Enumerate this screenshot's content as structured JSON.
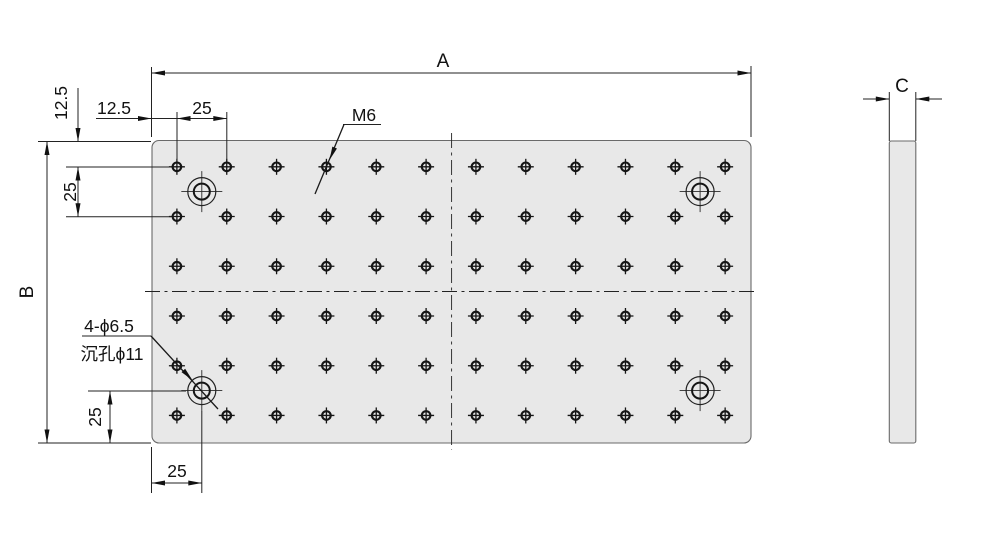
{
  "drawing": {
    "type": "engineering-drawing",
    "views": {
      "front": {
        "labels": {
          "width_dim": "A",
          "height_dim": "B",
          "edge_offset_horizontal": "12.5",
          "edge_offset_vertical": "12.5",
          "hole_pitch_horizontal": "25",
          "hole_pitch_vertical": "25",
          "cbore_offset_vertical": "25",
          "cbore_offset_horizontal": "25",
          "thread_callout": "M6",
          "cbore_callout_line1": "4-ϕ6.5",
          "cbore_callout_line2": "沉孔ϕ11"
        },
        "hole_grid": {
          "rows": 6,
          "cols": 12,
          "thread": "M6",
          "pitch": "25",
          "edge_offset": "12.5"
        },
        "counterbores": {
          "count": 4,
          "drill_diameter": "ϕ6.5",
          "cbore_diameter": "ϕ11",
          "offset_from_edges": "25"
        }
      },
      "side": {
        "labels": {
          "thickness_dim": "C"
        }
      }
    },
    "colors": {
      "plate_fill": "#e8e8e8",
      "line": "#222222",
      "text": "#111111",
      "background": "#ffffff"
    }
  },
  "geometry": {
    "plate": {
      "x": 152,
      "y": 140.5,
      "w": 599,
      "h": 302.5,
      "rx": 7
    },
    "grid": {
      "x0": 176.9,
      "y0": 166.8,
      "dx": 49.84,
      "dy": 49.73,
      "cols": 12,
      "rows": 6
    },
    "cbores": [
      [
        201.8,
        191.6
      ],
      [
        700.1,
        191.6
      ],
      [
        201.8,
        390.6
      ],
      [
        700.1,
        390.6
      ]
    ],
    "side": {
      "x": 889.3,
      "y": 141,
      "w": 26.5,
      "h": 302,
      "rx": 2
    }
  }
}
